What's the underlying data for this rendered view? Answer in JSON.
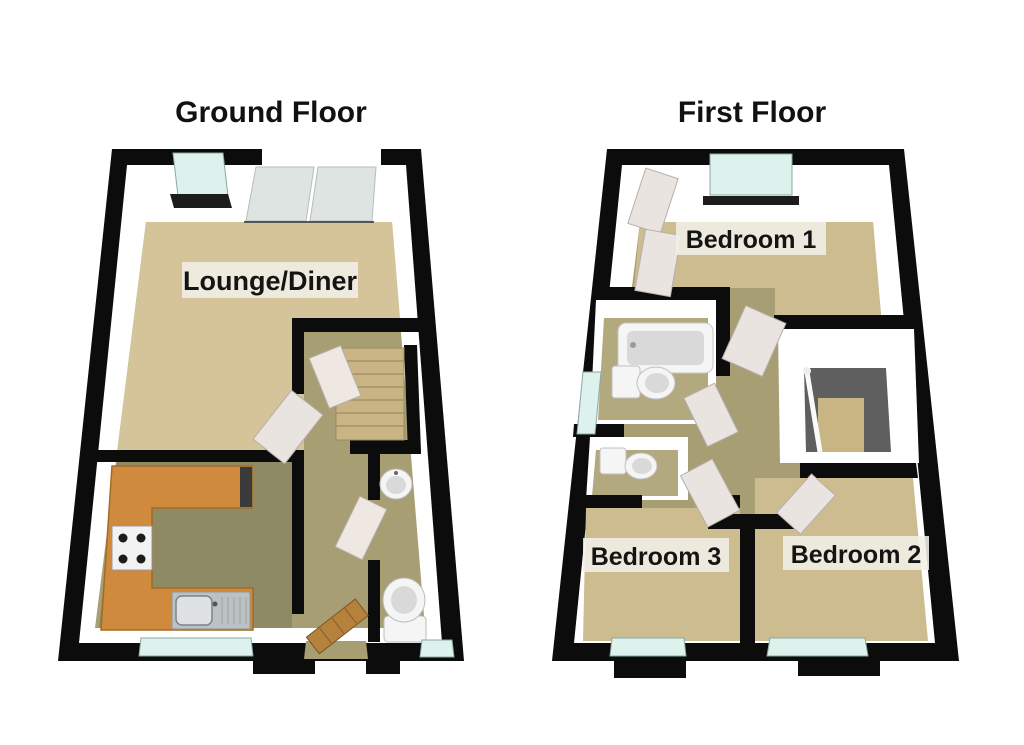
{
  "floors": {
    "ground": {
      "title": "Ground Floor",
      "rooms": {
        "lounge_diner": {
          "label": "Lounge/Diner"
        }
      }
    },
    "first": {
      "title": "First Floor",
      "rooms": {
        "bedroom1": {
          "label": "Bedroom 1"
        },
        "bedroom2": {
          "label": "Bedroom 2"
        },
        "bedroom3": {
          "label": "Bedroom 3"
        }
      }
    }
  },
  "colors": {
    "page_bg": "#ffffff",
    "wall": "#0c0c0c",
    "wall_face": "#ffffff",
    "carpet": "#d5c499",
    "bedroom_carpet": "#cdbc90",
    "hall_floor": "#a89e74",
    "bath_floor": "#b3a97e",
    "kitchen_floor": "#8e8a64",
    "stair_floor": "#5f5f5f",
    "stair_steps": "#c9b484",
    "counter": "#cf8a3d",
    "appliance_dark": "#3a3a3a",
    "window_glass": "#ddf2ec",
    "window_sill": "#1c1c1c",
    "patio_door": "#dde4e2",
    "door_white": "#eae4e1",
    "door_cream": "#efe8e2",
    "front_door": "#b5823d",
    "fixture": "#f5f5f5",
    "fixture_shade": "#d9d9d9",
    "hob_body": "#f2f2f2",
    "burner": "#1b1b1b",
    "sink_steel": "#bcc2c4",
    "sink_basin": "#dfe2e3",
    "label_bg": "#f2efe7",
    "label_text": "#141414",
    "title_text": "#111111"
  }
}
